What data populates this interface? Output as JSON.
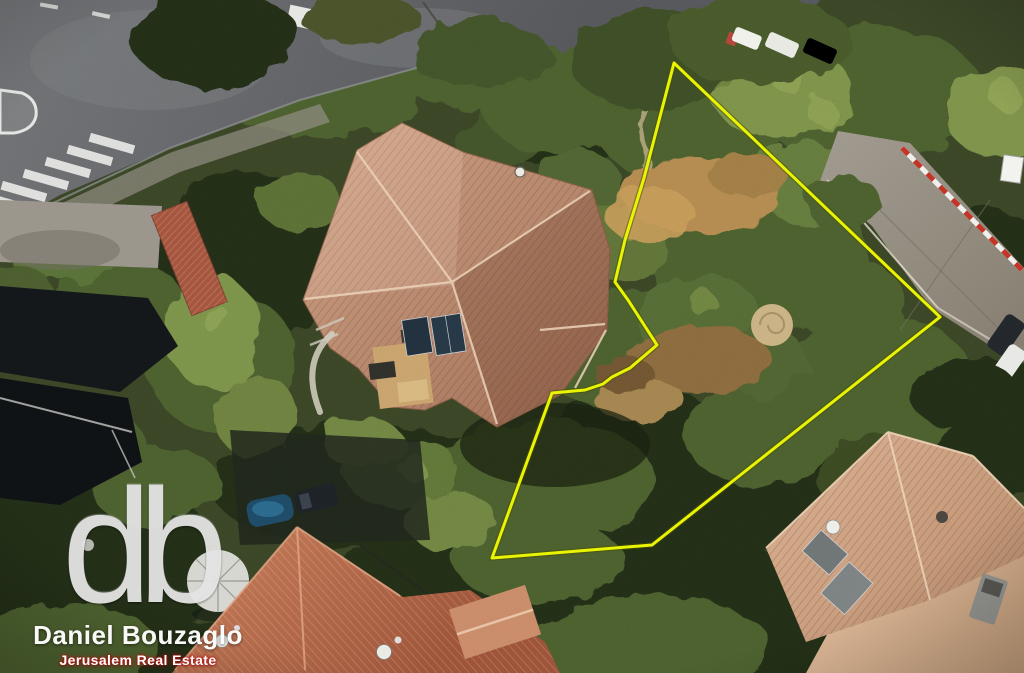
{
  "image": {
    "alt": "Aerial drone view of a wooded residential lot in Jerusalem with a yellow property boundary outline, a large tiled-roof house beside the marked parcel, roads at the top left and right, and neighboring red roofs"
  },
  "watermark": {
    "logo_text": "db",
    "name": "Daniel Bouzaglo",
    "tagline": "Jerusalem Real Estate"
  },
  "colors": {
    "boundary": "#e9f403",
    "logo_silver": "#e4e4e4",
    "tagline_red": "#c41111",
    "tree_dark": "#232f19",
    "tree_mid": "#4c5e2f",
    "tree_bright": "#7c9148",
    "asphalt": "#616366",
    "concrete_road": "#958d7d",
    "roof_terracotta": "#b98a6c",
    "roof_red": "#b26348",
    "roof_pale": "#cda285",
    "dirt": "#b3894f",
    "tarp_black": "#13171a"
  }
}
